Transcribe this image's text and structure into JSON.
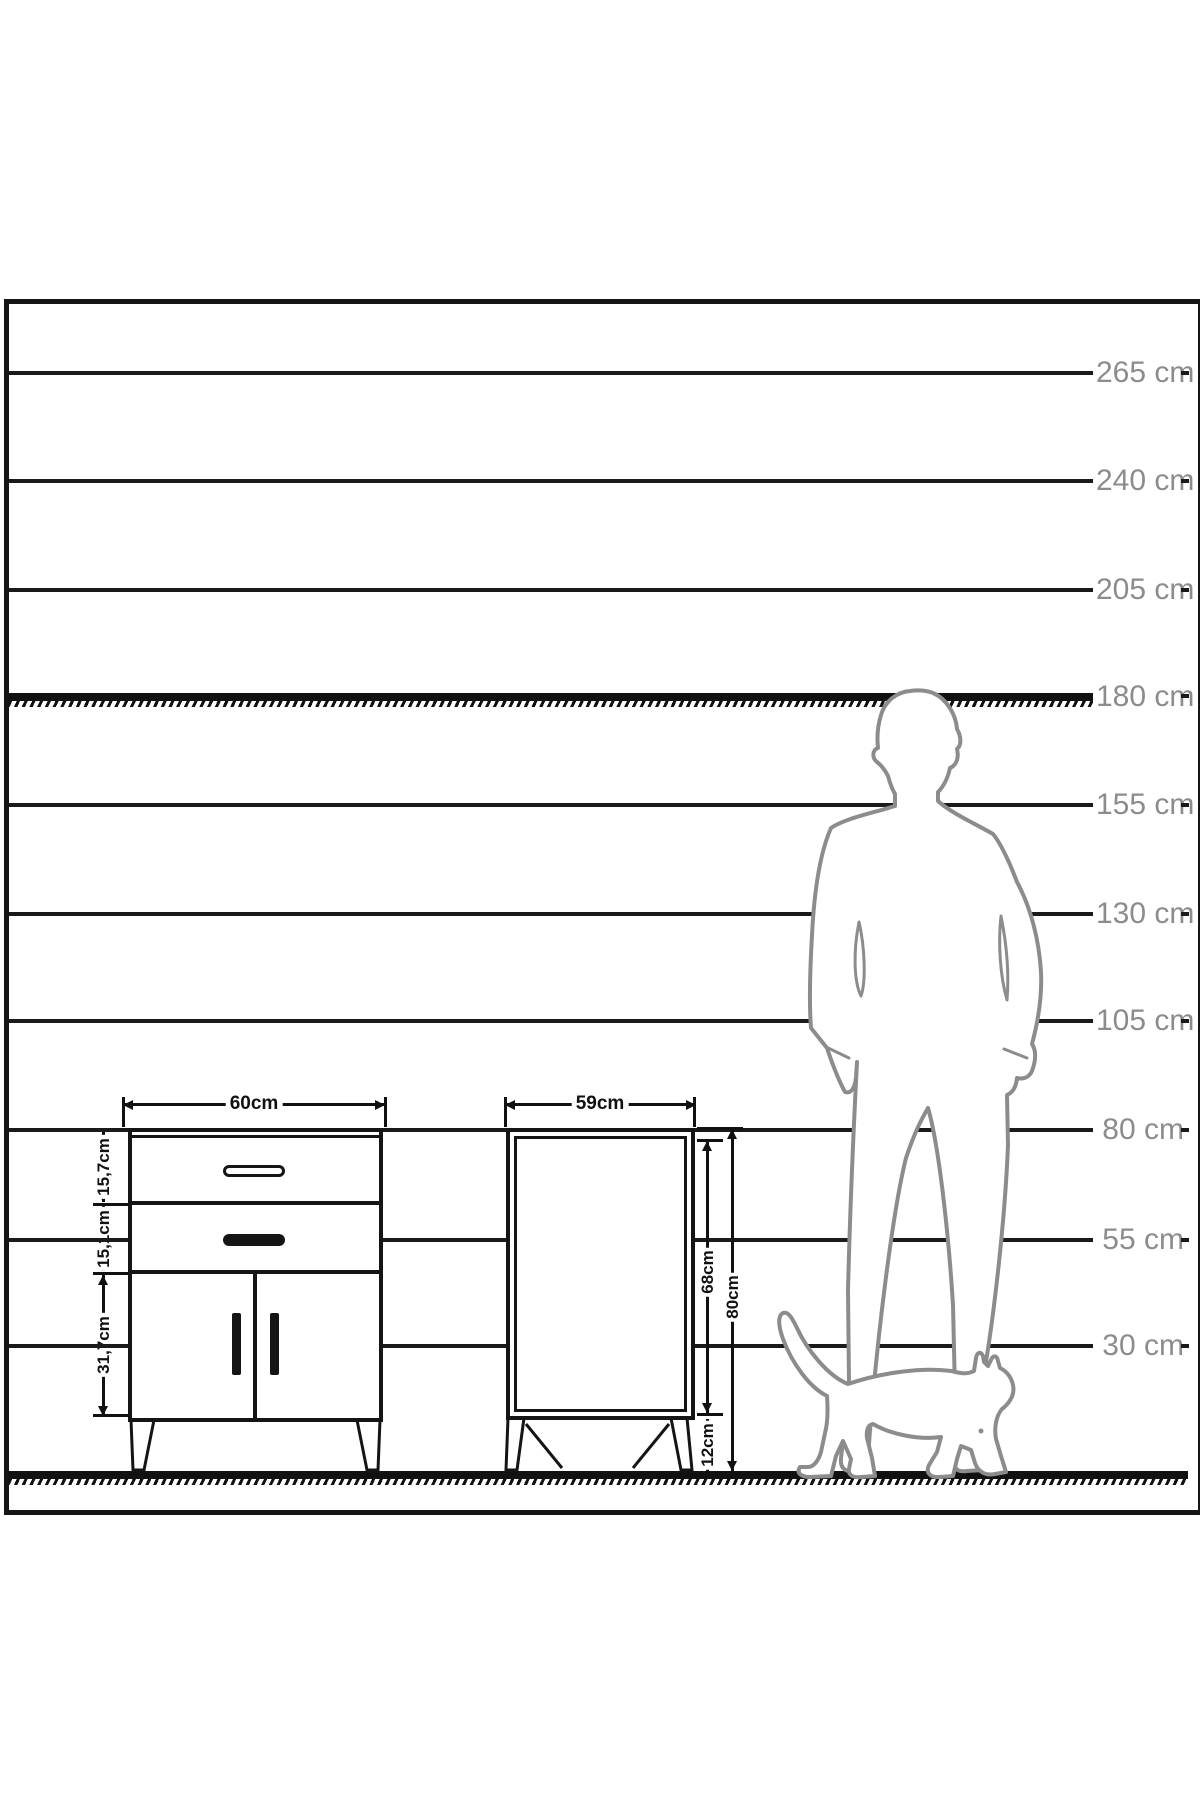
{
  "drawing": {
    "description": "Furniture dimension drawing with height scale, front and side cabinet views, man and cat silhouettes",
    "scale_labels": [
      {
        "label": "265 cm"
      },
      {
        "label": "240 cm"
      },
      {
        "label": "205 cm"
      },
      {
        "label": "180 cm"
      },
      {
        "label": "155 cm"
      },
      {
        "label": "130 cm"
      },
      {
        "label": "105 cm"
      },
      {
        "label": "80 cm"
      },
      {
        "label": "55 cm"
      },
      {
        "label": "30 cm"
      }
    ],
    "front_view": {
      "width": "60cm",
      "top_drawer_height": "15,7cm",
      "middle_drawer_height": "15,1cm",
      "door_section_height": "31,7cm"
    },
    "side_view": {
      "depth": "59cm",
      "body_height": "68cm",
      "total_height": "80cm",
      "leg_height": "12cm"
    },
    "colors": {
      "line": "#1a1a1a",
      "silhouette": "#8c8c8c",
      "scale_label_gray": "#8c8c8c"
    }
  }
}
